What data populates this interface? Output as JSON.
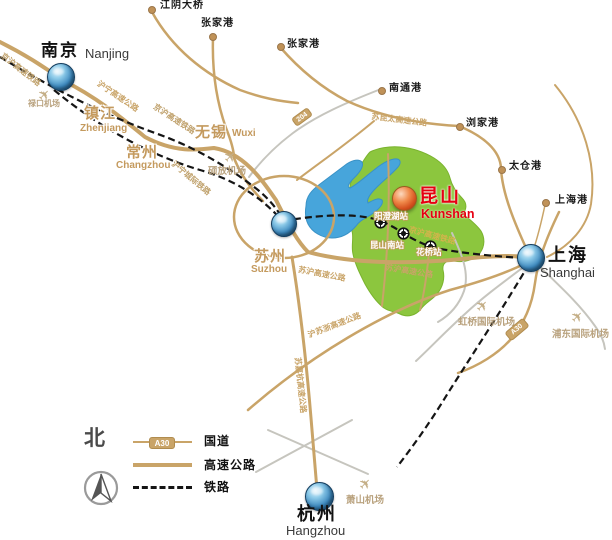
{
  "map": {
    "cities": {
      "nanjing": {
        "zh": "南京",
        "en": "Nanjing"
      },
      "zhenjiang": {
        "zh": "镇江",
        "en": "Zhenjiang"
      },
      "changzhou": {
        "zh": "常州",
        "en": "Changzhou"
      },
      "wuxi": {
        "zh": "无锡",
        "en": "Wuxi"
      },
      "suzhou": {
        "zh": "苏州",
        "en": "Suzhou"
      },
      "kunshan": {
        "zh": "昆山",
        "en": "Kunshan"
      },
      "shanghai": {
        "zh": "上海",
        "en": "Shanghai"
      },
      "hangzhou": {
        "zh": "杭州",
        "en": "Hangzhou"
      }
    },
    "ports": {
      "jiangyin_bridge": "江阴大桥",
      "zhangjiagang_n": "张家港",
      "zhangjiagang": "张家港",
      "nantong": "南通港",
      "liujiagang": "浏家港",
      "taicang": "太仓港",
      "shanghai_port": "上海港"
    },
    "airports": {
      "lukou": "禄口机场",
      "shuofang": "硕放机场",
      "hongqiao": "虹桥国际机场",
      "pudong": "浦东国际机场",
      "xiaoshan": "萧山机场"
    },
    "stations": {
      "yangchenghu": "阳澄湖站",
      "kunshan_south": "昆山南站",
      "huaqiao": "花桥站"
    },
    "railway_labels": {
      "jinghu_1": "京沪高速铁路",
      "jinghu_2": "京沪高速铁路",
      "huning_intercity": "沪宁城际铁路",
      "jinghu_3": "京沪高速铁路"
    },
    "road_labels": {
      "huning": "沪宁高速公路",
      "sukuntai": "苏昆太高速公路",
      "suhu_1": "苏沪高速公路",
      "suhu_2": "苏沪高速公路",
      "husuzhe": "沪苏浙高速公路",
      "sujiahang": "苏嘉杭高速公路"
    },
    "road_badges": {
      "g204": "204",
      "a30": "A30"
    }
  },
  "legend": {
    "north": "北",
    "badge": "A30",
    "national_road": "国道",
    "expressway": "高速公路",
    "railway": "铁路"
  },
  "colors": {
    "road_tan": "#c9a468",
    "road_gray": "#c6c5be",
    "railway_black": "#151515",
    "lake_blue": "#47a5db",
    "kunshan_green": "#8cc63e",
    "accent_red": "#e60012",
    "label_gold": "#c49a5e"
  }
}
